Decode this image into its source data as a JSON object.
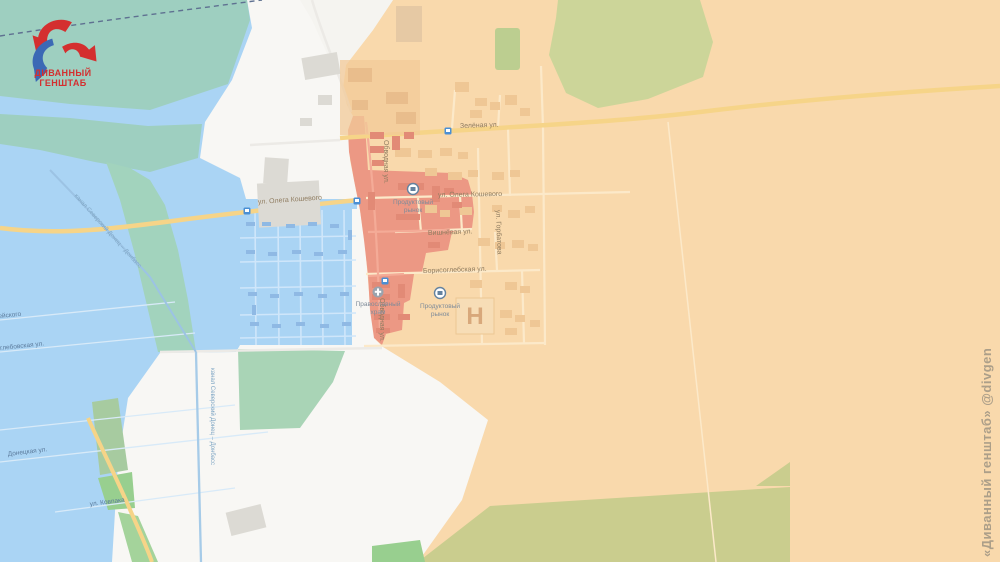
{
  "logo": {
    "line1": "ДИВАННЫЙ",
    "line2": "ГЕНШТАБ"
  },
  "watermark": "«Диванный генштаб» @divgen",
  "map": {
    "streets": {
      "zelenaya": "Зелёная ул.",
      "kosheviy_w": "ул. Олега Кошевого",
      "kosheviy_e": "ул. Олега Кошевого",
      "obvodnaya1": "Обводная ул.",
      "obvodnaya2": "Обводная ул.",
      "gorbatova": "ул. Горбатова",
      "vishnevaya": "Вишнёвая ул.",
      "borisoglebskaya": "Борисоглебская ул.",
      "shosseyskogo": "ул. Шоссейского",
      "petroglebovskaya": "Петроглебовская ул.",
      "donetskaya": "Донецкая ул.",
      "kovpaka": "ул. Ковпака"
    },
    "waterways": {
      "canal_diag": "канал Северский Донец – Донбасс",
      "canal_vert": "канал Северский Донец – Донбасс"
    },
    "pois": {
      "market1_l1": "Продуктовый",
      "market1_l2": "рынок",
      "market2_l1": "Продуктовый",
      "market2_l2": "рынок",
      "church_l1": "Православный",
      "church_l2": "храм",
      "hospital": "Н"
    },
    "zone_colors": {
      "orange_zone": "#f9d9ac",
      "white_zone": "#f8f7f4",
      "blue_zone": "#aad4f4",
      "red_zone": "#ec9884",
      "forest": "#ccd599",
      "field": "#cacd8e",
      "water_teal": "#9ecfc0"
    }
  }
}
